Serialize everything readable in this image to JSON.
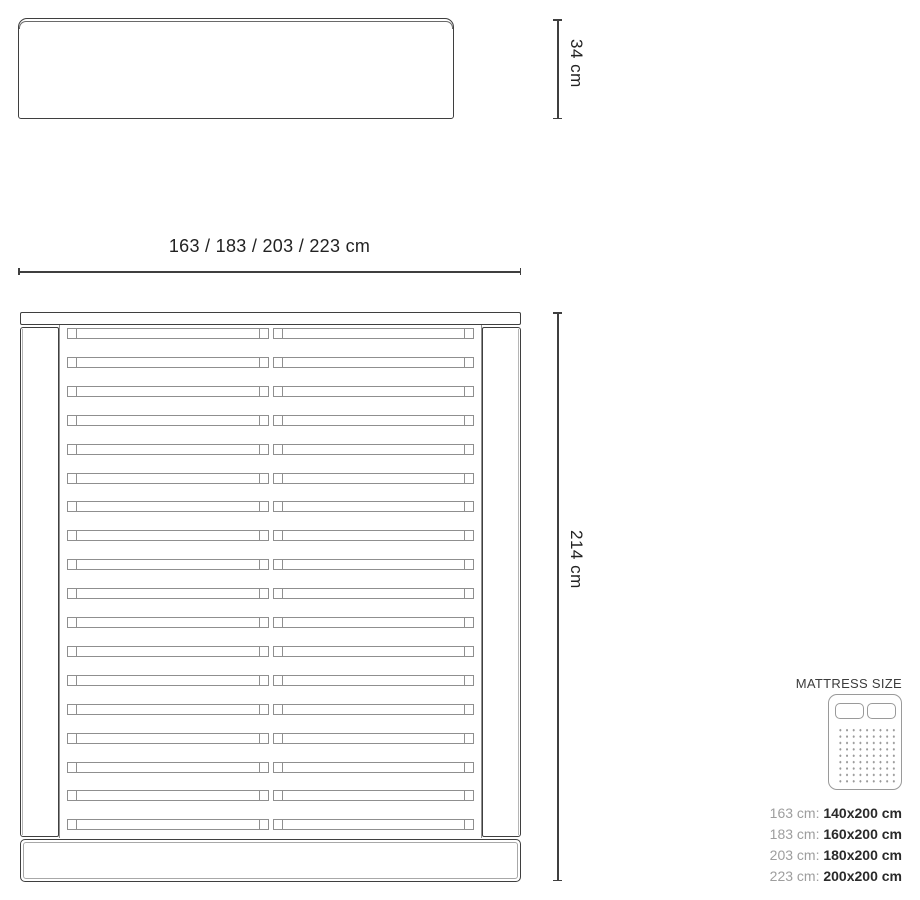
{
  "page": {
    "type": "product-dimension-diagram",
    "background": "#ffffff"
  },
  "colors": {
    "outline_dark": "#3f3f3f",
    "outline_mid": "#8f8f8f",
    "outline_light": "#b5b5b5",
    "legend_gray": "#9a9a9a",
    "text_dark": "#2a2a2a",
    "text_gray": "#9e9e9e"
  },
  "headboard_view": {
    "height_label": "34 cm"
  },
  "bed_view": {
    "width_label": "163 / 183 / 203 / 223 cm",
    "length_label": "214 cm",
    "slat_rows": 18
  },
  "legend": {
    "title": "MATTRESS SIZE",
    "icon": "mattress-icon",
    "rows": [
      {
        "frame": "163 cm:",
        "mattress": "140x200 cm"
      },
      {
        "frame": "183 cm:",
        "mattress": "160x200 cm"
      },
      {
        "frame": "203 cm:",
        "mattress": "180x200 cm"
      },
      {
        "frame": "223 cm:",
        "mattress": "200x200 cm"
      }
    ]
  }
}
